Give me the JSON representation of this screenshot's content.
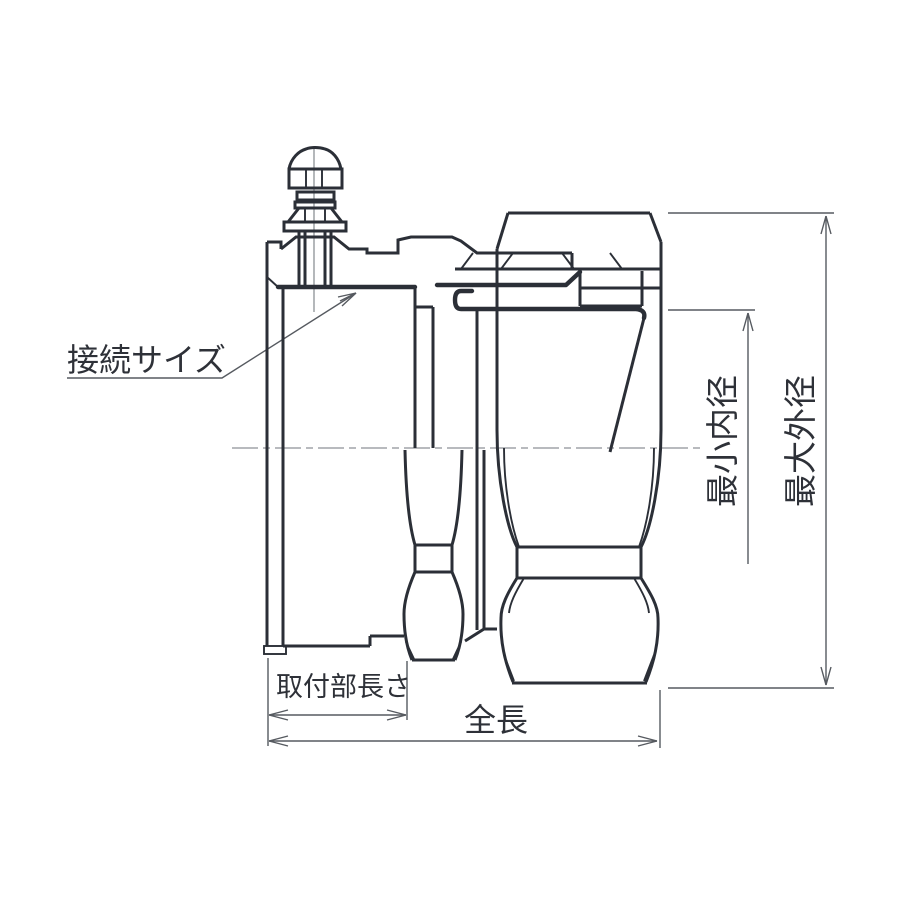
{
  "diagram": {
    "kind": "technical-dimension-drawing",
    "labels": {
      "connection_size": "接続サイズ",
      "min_inner_diameter": "最小内径",
      "max_outer_diameter": "最大外径",
      "mount_length": "取付部長さ",
      "total_length": "全長"
    },
    "colors": {
      "outline": "#2b2f37",
      "dimension_line": "#565a60",
      "centerline": "#8d9196",
      "text": "#2e3138",
      "background": "#ffffff"
    }
  }
}
